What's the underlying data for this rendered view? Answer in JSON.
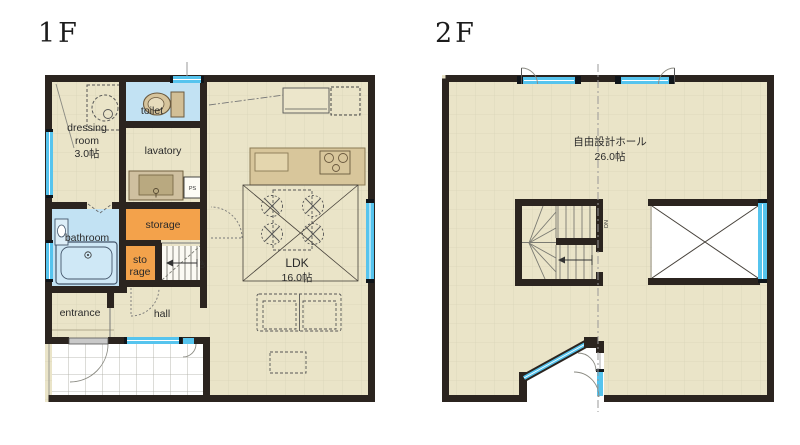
{
  "document": {
    "type": "house-floor-plan"
  },
  "floors": {
    "f1": {
      "title": "1F",
      "labels": {
        "dressing1": "dressing",
        "dressing2": "room",
        "dressing_size": "3.0帖",
        "toilet": "toilet",
        "lavatory": "lavatory",
        "ps": "PS",
        "storage": "storage",
        "storage2a": "sto",
        "storage2b": "rage",
        "bathroom": "bathroom",
        "entrance": "entrance",
        "hall": "hall",
        "ldk": "LDK",
        "ldk_size": "16.0帖",
        "stair": "UP"
      }
    },
    "f2": {
      "title": "2F",
      "labels": {
        "hall": "自由設計ホール",
        "hall_size": "26.0帖",
        "stair": "DN"
      }
    }
  },
  "colors": {
    "floor_beige": "#eae4c8",
    "grid_line": "#d9d3b8",
    "wall_dark": "#2b241f",
    "wet_area_blue": "#c2e2f3",
    "window_blue": "#56c4ee",
    "storage_orange": "#f3a24b",
    "counter_tan": "#d8c69b",
    "porch_white": "#ffffff"
  }
}
